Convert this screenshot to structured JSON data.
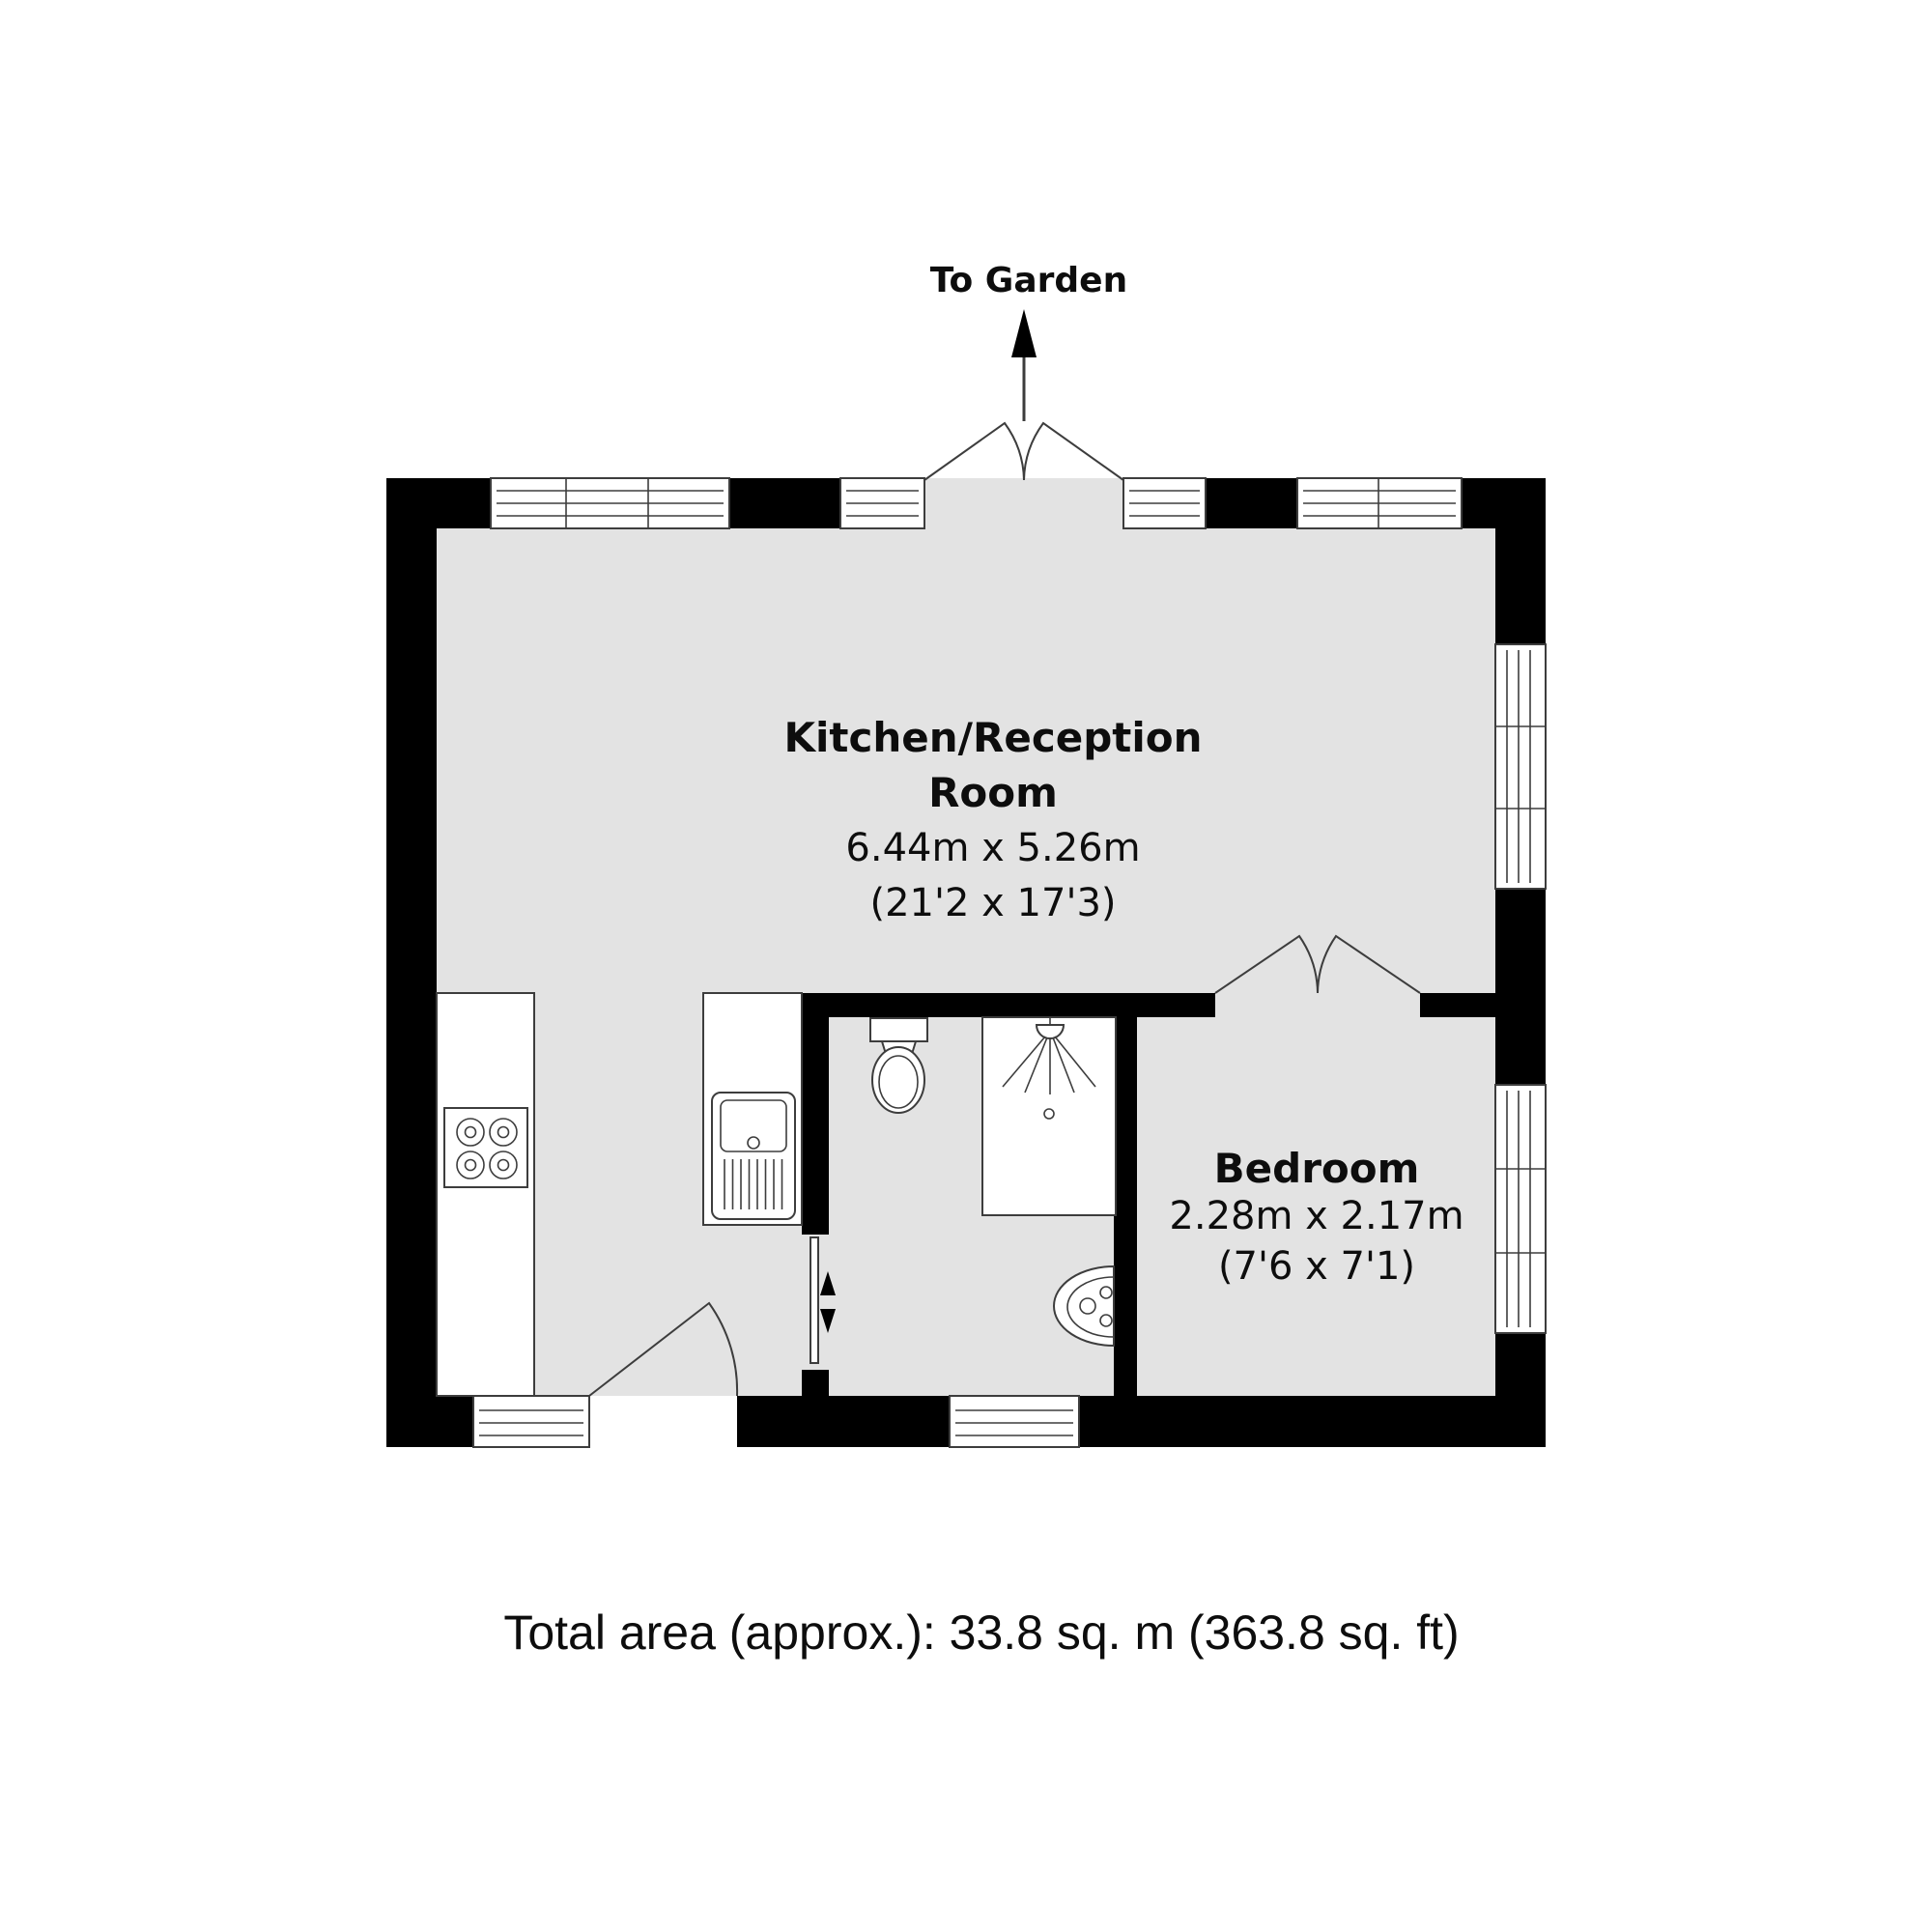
{
  "plan": {
    "garden_label": "To Garden",
    "rooms": [
      {
        "name_line1": "Kitchen/Reception",
        "name_line2": "Room",
        "dims_metric": "6.44m x 5.26m",
        "dims_imperial": "(21'2 x 17'3)"
      },
      {
        "name_line1": "Bedroom",
        "dims_metric": "2.28m x 2.17m",
        "dims_imperial": "(7'6 x 7'1)"
      }
    ],
    "footer": {
      "total_area": "Total area (approx.): 33.8 sq. m (363.8 sq. ft)"
    },
    "fixtures": [
      "hob",
      "kitchen-sink",
      "toilet",
      "shower",
      "basin",
      "sliding-door",
      "entrance-door",
      "french-doors",
      "bedroom-double-doors"
    ],
    "colors": {
      "wall": "#000000",
      "floor": "#e3e3e3",
      "line": "#3d3d3d",
      "background": "#ffffff",
      "text": "#0d0d0d"
    }
  }
}
